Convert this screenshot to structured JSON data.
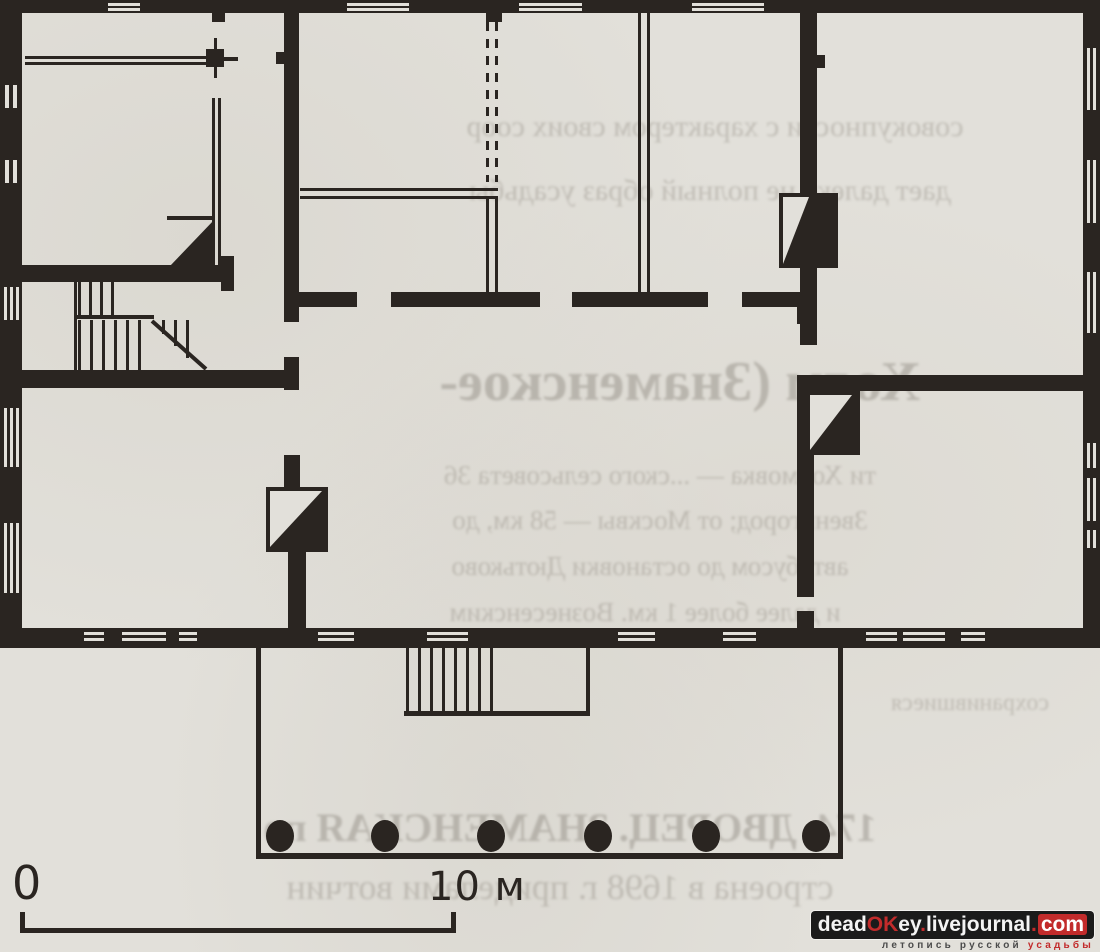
{
  "document": {
    "type": "scanned-architectural-floor-plan",
    "paper_color": "#e2e0da",
    "ink_color": "#2a2521"
  },
  "scale_bar": {
    "start_label": "0",
    "end_label": "10 м"
  },
  "watermark": {
    "box_background": "#1b1b1b",
    "accent_color": "#c22b2b",
    "part_dead": "dead",
    "part_ok": "OK",
    "part_ey": "ey",
    "dot1": ".",
    "part_livejournal": "livejournal",
    "dot2": ".",
    "part_com": "com",
    "tagline_main": "летопись русской ",
    "tagline_accent": "усадьбы"
  },
  "ghost_text": {
    "g1": "совокупности с характером своих соор",
    "g2": "дает далеко не полный образ усадьбы",
    "g3": "Холм (Знаменское-",
    "g4": "ти Холмовка — ...ского сельсовета 36",
    "g5": "Звенигород; от Москвы — 58 км, до",
    "g6": "автобусом до остановки Дютьково",
    "g7": "и далее более 1 км. Вознесенским",
    "g8": "174. ДВОРЕЦ. ЗНАМЕНСКАЯ по",
    "g9": "строена в 1698 г. приделами вотчин",
    "g10": "сохранившиеся"
  },
  "plan_features": {
    "stove_count": 3,
    "porch_column_count": 6,
    "staircase_count": 2,
    "entrance_steps": 1
  }
}
